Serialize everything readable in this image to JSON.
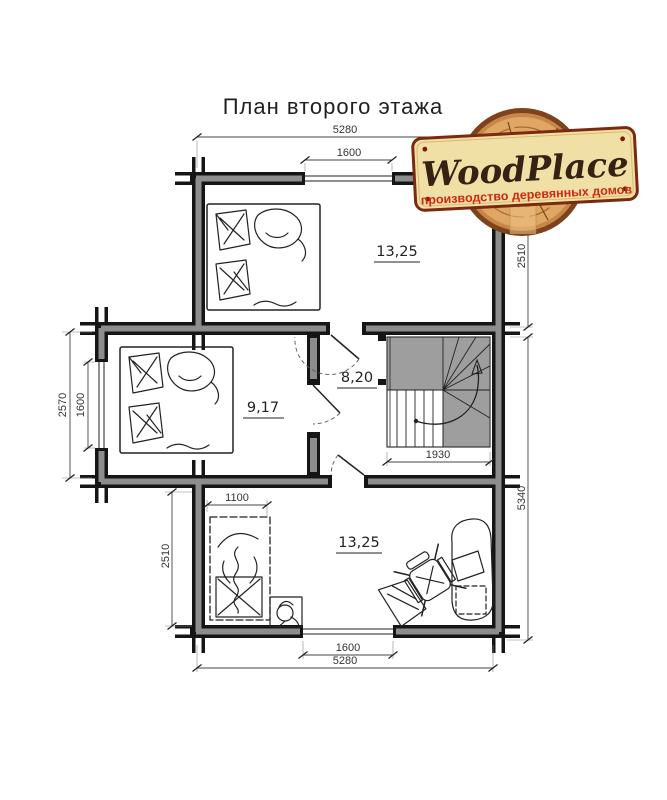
{
  "title": "План второго этажа",
  "logo": {
    "brand": "WoodPlace",
    "tagline": "производство деревянных домов",
    "colors": {
      "plank": "#f1e0a6",
      "plank_border": "#7a2a10",
      "wood": "#dfa763",
      "bark": "#7e431c",
      "brand_text": "#362214",
      "tagline_text": "#cd2910",
      "nail": "#7c1608"
    }
  },
  "plan": {
    "rooms": [
      {
        "id": "bedroom-top",
        "area": "13,25"
      },
      {
        "id": "bedroom-left",
        "area": "9,17"
      },
      {
        "id": "hall",
        "area": "8,20"
      },
      {
        "id": "bedroom-bottom",
        "area": "13,25"
      }
    ],
    "dimensions": {
      "top_total": "5280",
      "top_window": "1600",
      "right_upper": "2510",
      "right_lower": "5340",
      "left_outer": "2570",
      "left_window": "1600",
      "room_bottom_height": "2510",
      "bed_width": "1100",
      "stairs_width": "1930",
      "bottom_window": "1600",
      "bottom_total": "5280"
    },
    "colors": {
      "wall": "#151515",
      "wall_fill": "#8d8d8d",
      "stairs_fill": "#9e9e9e",
      "dim_text": "#333333"
    }
  }
}
